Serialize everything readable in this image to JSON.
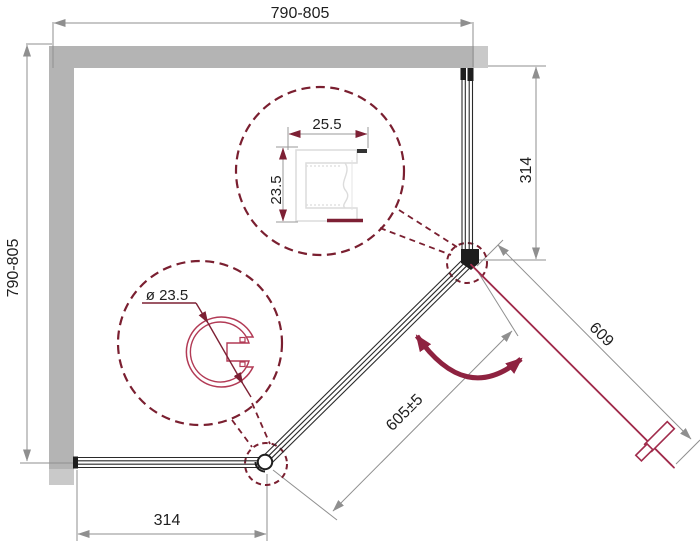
{
  "drawing": {
    "title": "shower-enclosure-pentagonal-plan",
    "dimensions": {
      "top_width": "790-805",
      "left_depth": "790-805",
      "right_panel": "314",
      "bottom_panel": "314",
      "door_width": "609",
      "opening_width": "605±5"
    },
    "details": {
      "wall_profile_width": "25.5",
      "wall_profile_height": "23.5",
      "hinge_profile_diameter": "ø 23.5"
    },
    "icons": {
      "swing": "door-swing-arrow"
    },
    "colors": {
      "wall": "#b4b4b4",
      "wall_light": "#c9c9c9",
      "glass": "#2a2a2a",
      "door": "#a12c4c",
      "accent_dashed": "#7a1f30",
      "dimension": "#8f8f8f",
      "profile_light": "#dcdcdc"
    }
  }
}
